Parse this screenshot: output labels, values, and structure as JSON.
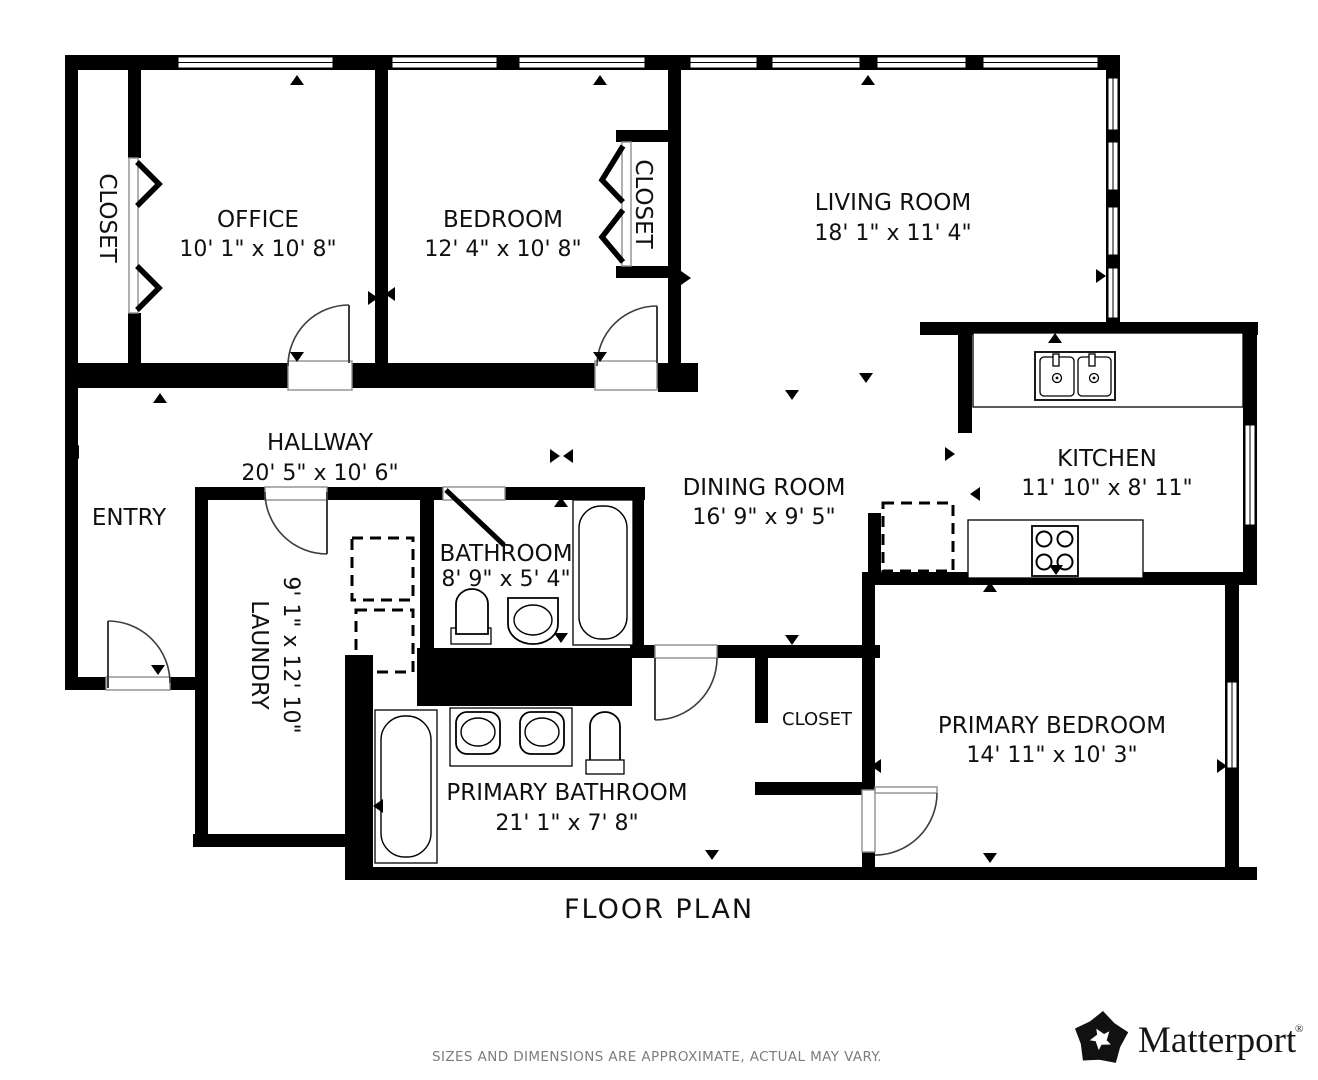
{
  "title": "FLOOR PLAN",
  "disclaimer": "SIZES AND DIMENSIONS ARE APPROXIMATE, ACTUAL MAY VARY.",
  "brand": {
    "name": "Matterport",
    "registered": "®"
  },
  "colors": {
    "walls": "#000000",
    "background": "#ffffff",
    "label_text": "#101010",
    "disclaimer_text": "#7d7d7d"
  },
  "rooms": [
    {
      "id": "office",
      "name": "OFFICE",
      "dims": "10' 1\" x 10' 8\""
    },
    {
      "id": "bedroom",
      "name": "BEDROOM",
      "dims": "12' 4\" x 10' 8\""
    },
    {
      "id": "living_room",
      "name": "LIVING ROOM",
      "dims": "18' 1\" x 11' 4\""
    },
    {
      "id": "hallway",
      "name": "HALLWAY",
      "dims": "20' 5\" x 10' 6\""
    },
    {
      "id": "entry",
      "name": "ENTRY",
      "dims": ""
    },
    {
      "id": "kitchen",
      "name": "KITCHEN",
      "dims": "11' 10\" x 8' 11\""
    },
    {
      "id": "dining_room",
      "name": "DINING ROOM",
      "dims": "16' 9\" x 9' 5\""
    },
    {
      "id": "bathroom",
      "name": "BATHROOM",
      "dims": "8' 9\" x 5' 4\""
    },
    {
      "id": "laundry",
      "name": "LAUNDRY",
      "dims": "9' 1\" x 12' 10\""
    },
    {
      "id": "primary_bedroom",
      "name": "PRIMARY BEDROOM",
      "dims": "14' 11\" x 10' 3\""
    },
    {
      "id": "primary_bathroom",
      "name": "PRIMARY BATHROOM",
      "dims": "21' 1\" x 7' 8\""
    },
    {
      "id": "closet_office",
      "name": "CLOSET",
      "dims": ""
    },
    {
      "id": "closet_bedroom",
      "name": "CLOSET",
      "dims": ""
    },
    {
      "id": "closet_primary",
      "name": "CLOSET",
      "dims": ""
    }
  ],
  "fixtures": [
    "double-kitchen-sink",
    "stove-four-burner",
    "refrigerator-dashed-outline",
    "washer-dashed-outline",
    "dryer-dashed-outline",
    "bathtub",
    "toilet",
    "pedestal-sink",
    "double-vanity-sink",
    "door-swing",
    "bifold-closet-door",
    "window",
    "scan-direction-marker"
  ]
}
